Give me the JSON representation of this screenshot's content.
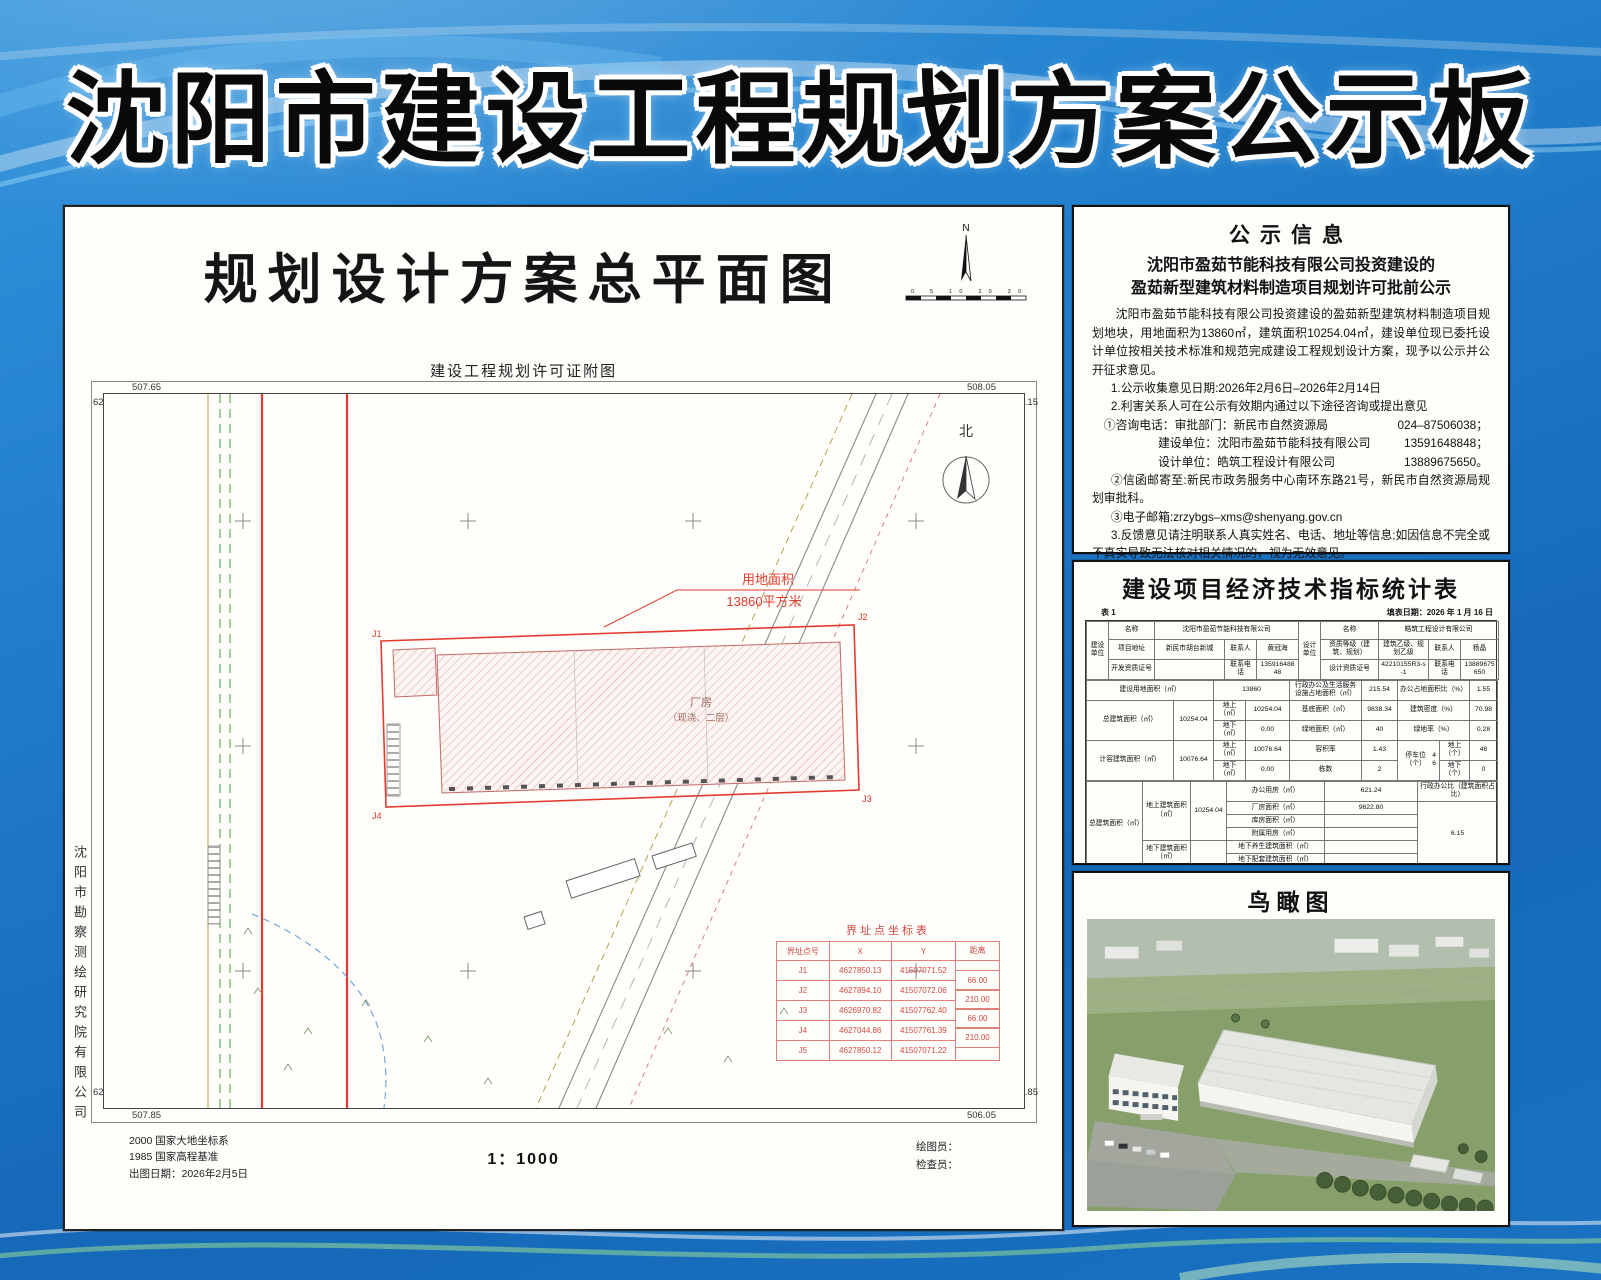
{
  "header": {
    "title": "沈阳市建设工程规划方案公示板"
  },
  "plan": {
    "title": "规划设计方案总平面图",
    "subtitle": "建设工程规划许可证附图",
    "north_n": "N",
    "scale_ticks": "0 5 10 20 30",
    "north_cn": "北",
    "company_vertical": "沈阳市勘察测绘研究院有限公司",
    "area_callout1": "用地面积",
    "area_callout2": "13860平方米",
    "bldg1": "厂房",
    "bldg2": "（现浇、二层）",
    "j_labels": [
      "J1",
      "J2",
      "J3",
      "J4"
    ],
    "corners": {
      "tl_x": "507.65",
      "tl_y": "627.15",
      "tr_x": "508.05",
      "tr_y": "627.15",
      "bl_y": "626.85",
      "bl_x": "507.85",
      "br_y": "626.85",
      "br_x": "506.05"
    },
    "coord_table": {
      "title": "界址点坐标表",
      "h": [
        "界址点号",
        "X",
        "Y",
        "距离"
      ],
      "rows": [
        [
          "J1",
          "4627850.13",
          "41507071.52"
        ],
        [
          "J2",
          "4627894.10",
          "41507072.06"
        ],
        [
          "J3",
          "4626970.82",
          "41507762.40"
        ],
        [
          "J4",
          "4627044.86",
          "41507761.39"
        ],
        [
          "J5",
          "4627850.12",
          "41507071.22"
        ]
      ],
      "dists": [
        "66.00",
        "210.00",
        "66.00",
        "210.00"
      ]
    },
    "datum1": "2000 国家大地坐标系",
    "datum2": "1985 国家高程基准",
    "date": "出图日期：2026年2月5日",
    "scale": "1：1000",
    "drafter": "绘图员：",
    "checker": "检查员："
  },
  "notice": {
    "title": "公示信息",
    "sub1": "沈阳市盈茹节能科技有限公司投资建设的",
    "sub2": "盈茹新型建筑材料制造项目规划许可批前公示",
    "para": "沈阳市盈茹节能科技有限公司投资建设的盈茹新型建筑材料制造项目规划地块，用地面积为13860㎡，建筑面积10254.04㎡，建设单位现已委托设计单位按相关技术标准和规范完成建设工程规划设计方案，现予以公示并公开征求意见。",
    "item1": "1.公示收集意见日期:2026年2月6日–2026年2月14日",
    "item2": "2.利害关系人可在公示有效期内通过以下途径咨询或提出意见",
    "tel_label": "①咨询电话：审批部门：新民市自然资源局",
    "tel1": "024–87506038；",
    "unit2": "建设单位：沈阳市盈茹节能科技有限公司",
    "tel2": "13591648848；",
    "unit3": "设计单位：皓筑工程设计有限公司",
    "tel3": "13889675650。",
    "mail": "②信函邮寄至:新民市政务服务中心南环东路21号，新民市自然资源局规划审批科。",
    "email": "③电子邮箱:zrzybgs–xms@shenyang.gov.cn",
    "item3": "3.反馈意见请注明联系人真实姓名、电话、地址等信息;如因信息不完全或不真实导致无法核对相关情况的，视为无效意见。",
    "item4": "4.本方案涉及的利害关系人依法享有听证权。",
    "sign1": "新民市自然资源局",
    "sign2": "2026年2月6日"
  },
  "ind": {
    "title": "建设项目经济技术指标统计表",
    "table_no": "表 1",
    "date": "填表日期：2026 年 1 月 16 日",
    "jsdw": "建设单位",
    "sjdw": "设计单位",
    "mc": "名称",
    "jsdw_mc": "沈阳市盈茹节能科技有限公司",
    "xmdz_l": "项目地址",
    "xmdz": "新民市胡台新城",
    "lxr": "联系人",
    "jsdw_lxr": "黄冠海",
    "kfzz_l": "开发资质证号",
    "kfzz": "",
    "lxdh": "联系电话",
    "jsdw_dh": "13591648848",
    "sjdw_mc": "皓筑工程设计有限公司",
    "zzdj_l": "资质等级（建筑、规划）",
    "zzdj": "建筑乙级、规划乙级",
    "sjdw_lxr": "杨晶",
    "sjzz_l": "设计资质证号",
    "sjzz": "42210155R3-s-1",
    "sjdw_dh": "13889675650",
    "jsyd_l": "建设用地面积（㎡）",
    "jsyd": "13860",
    "xzbg_l": "行政办公及生活服务设施占地面积（㎡）",
    "xzbg": "215.54",
    "bgzd_l": "办公占地面积比（%）",
    "bgzd": "1.55",
    "zjzmj_l": "总建筑面积（㎡）",
    "zjzmj": "10254.04",
    "ds_l": "地上（㎡）",
    "dx_l": "地下（㎡）",
    "zjz_ds": "10254.04",
    "zjz_dx": "0.00",
    "jdmj_l": "基底面积（㎡）",
    "jdmj": "9838.34",
    "jzmd_l": "建筑密度（%）",
    "jzmd": "70.98",
    "ldmj_l": "绿地面积（㎡）",
    "ldmj": "40",
    "ldl_l": "绿地率（%）",
    "ldl": "0.28",
    "jrjzmj_l": "计容建筑面积（㎡）",
    "jrjzmj": "10076.64",
    "jr_ds": "10076.64",
    "jr_dx": "0.00",
    "rjl_l": "容积率",
    "rjl": "1.43",
    "tcw_l": "停车位（个）",
    "tcw": "46",
    "tcw_ds_l": "地上（个）",
    "tcw_ds": "46",
    "tcw_dx_l": "地下（个）",
    "tcw_dx": "0",
    "dsh_l": "栋数",
    "dsh": "2",
    "dsjz_l": "地上建筑面积（㎡）",
    "dsjz": "10254.04",
    "dxjz_l": "地下建筑面积（㎡）",
    "dxjz": "",
    "bgyf_l": "办公用房（㎡）",
    "bgyf": "621.24",
    "cfmj_l": "厂房面积（㎡）",
    "cfmj": "9622.80",
    "kfmj_l": "库房面积（㎡）",
    "kfmj": "",
    "fsyf_l": "附属用房（㎡）",
    "fsyf": "",
    "dxys_l": "地下养生建筑面积（㎡）",
    "dxys": "",
    "dxpt_l": "地下配套建筑面积（㎡）",
    "dxpt": "",
    "xzbgb_l": "行政办公比（建筑面积占比）",
    "xzbgb": "6.15",
    "jzxs_l": "建筑形式",
    "mj_l": "面积",
    "xs1": "工业厂房",
    "xs2": "仓储区",
    "xs3": "工业办公",
    "xs4": "备注",
    "xs1_v": "9622.80",
    "xs2_v": "",
    "xs3_v": "621.24",
    "xs4_v": "",
    "pjtcw_l": "配建停车位（个）",
    "pj1": "39",
    "pj2": "",
    "pj3": "7",
    "pj4": ""
  },
  "aerial": {
    "title": "鸟瞰图"
  }
}
